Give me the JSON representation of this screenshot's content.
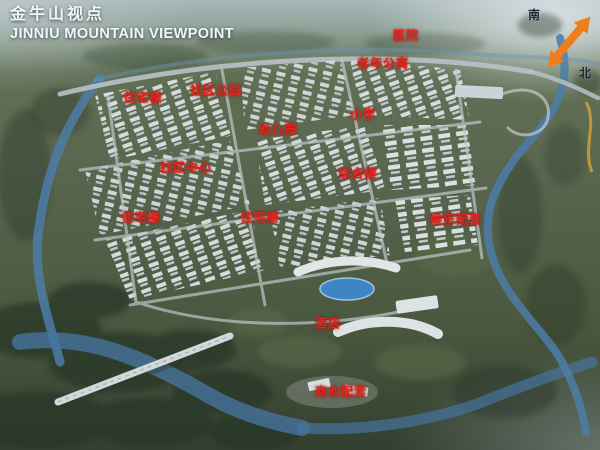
{
  "header": {
    "title_zh": "金牛山视点",
    "title_en": "JINNIU MOUNTAIN VIEWPOINT"
  },
  "compass": {
    "south_label": "南",
    "north_label": "北"
  },
  "colors": {
    "label_red": "#e2251c",
    "arrow_orange": "#ef7d1a",
    "river_blue": "#4e7da7",
    "title_white": "#f3f6f8"
  },
  "map_labels": [
    {
      "text": "医院",
      "x": 406,
      "y": 35
    },
    {
      "text": "老年公寓",
      "x": 383,
      "y": 63
    },
    {
      "text": "住宅楼",
      "x": 143,
      "y": 97
    },
    {
      "text": "社区公园",
      "x": 216,
      "y": 90
    },
    {
      "text": "幼儿园",
      "x": 278,
      "y": 129
    },
    {
      "text": "小学",
      "x": 363,
      "y": 114
    },
    {
      "text": "社区中心",
      "x": 186,
      "y": 167
    },
    {
      "text": "综合楼",
      "x": 358,
      "y": 173
    },
    {
      "text": "住宅楼",
      "x": 141,
      "y": 217
    },
    {
      "text": "住宅楼",
      "x": 260,
      "y": 217
    },
    {
      "text": "娱乐配套",
      "x": 456,
      "y": 219
    },
    {
      "text": "酒店",
      "x": 328,
      "y": 323
    },
    {
      "text": "商业配套",
      "x": 341,
      "y": 391
    }
  ]
}
